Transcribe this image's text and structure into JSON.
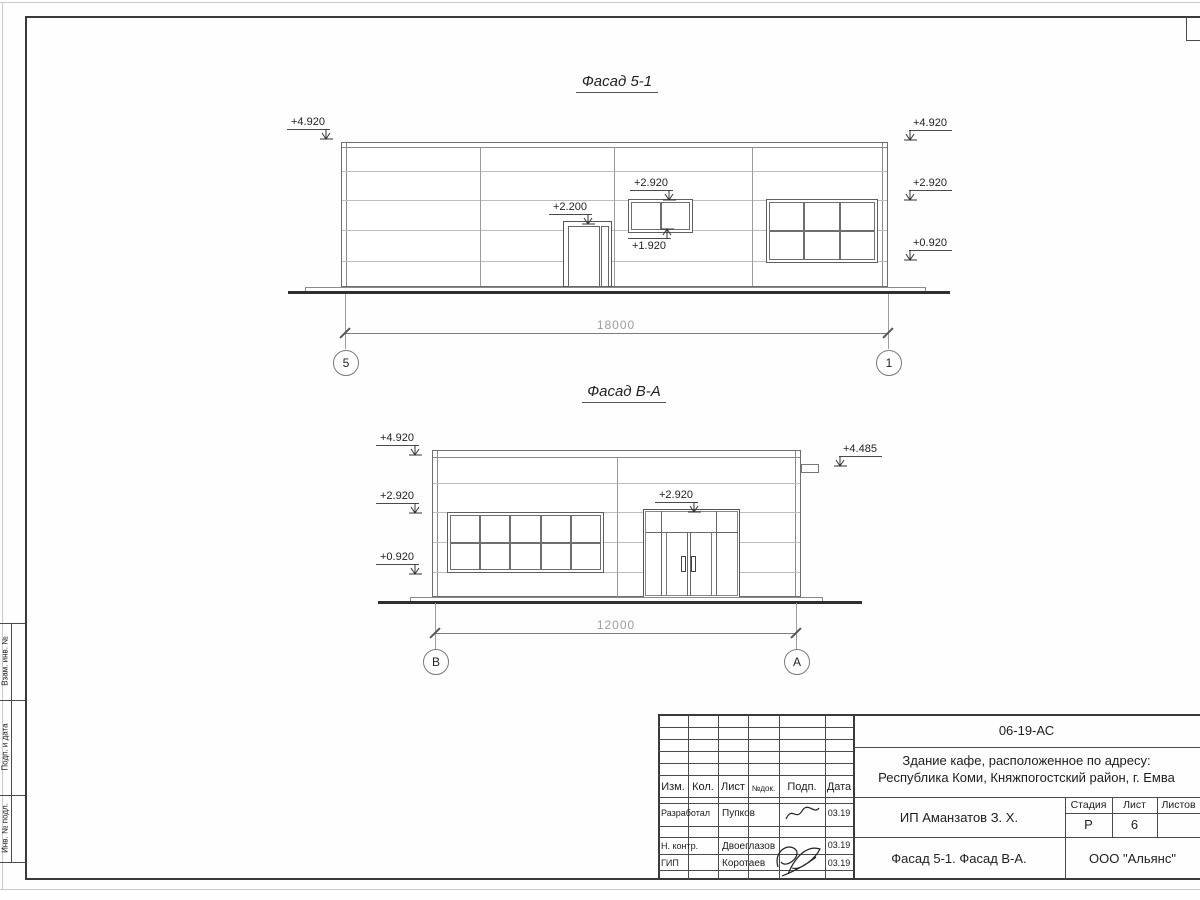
{
  "sheet": {
    "side_column_labels": [
      "Взам. инв. №",
      "Подп. и дата",
      "Инв. № подл."
    ]
  },
  "facade1": {
    "title": "Фасад 5-1",
    "marks": {
      "left_top": "+4.920",
      "door": "+2.200",
      "window_top": "+2.920",
      "window_bottom": "+1.920",
      "right_top": "+4.920",
      "right_mid": "+2.920",
      "right_low": "+0.920"
    },
    "dimension": "18000",
    "axis_left": "5",
    "axis_right": "1"
  },
  "facade2": {
    "title": "Фасад В-А",
    "marks": {
      "left_top": "+4.920",
      "left_mid": "+2.920",
      "left_low": "+0.920",
      "entrance": "+2.920",
      "right_top": "+4.485"
    },
    "dimension": "12000",
    "axis_left": "В",
    "axis_right": "А"
  },
  "title_block": {
    "doc_number": "06-19-АС",
    "project_line1": "Здание кафе, расположенное по адресу:",
    "project_line2": "Республика Коми, Княжпогостский район, г. Емва",
    "client": "ИП Аманзатов З. Х.",
    "sheet_name": "Фасад 5-1. Фасад В-А.",
    "company": "ООО \"Альянс\"",
    "col_headers": {
      "izm": "Изм.",
      "kol": "Кол.",
      "list": "Лист",
      "ndoc": "№док.",
      "podp": "Подп.",
      "data": "Дата"
    },
    "stage_header": "Стадия",
    "sheet_header": "Лист",
    "sheets_header": "Листов",
    "stage": "Р",
    "sheet_no": "6",
    "signers": [
      {
        "role": "Разработал",
        "name": "Пупков",
        "date": "03.19"
      },
      {
        "role": "Н. контр.",
        "name": "Двоеглазов",
        "date": "03.19"
      },
      {
        "role": "ГИП",
        "name": "Коротаев",
        "date": "03.19"
      }
    ]
  }
}
